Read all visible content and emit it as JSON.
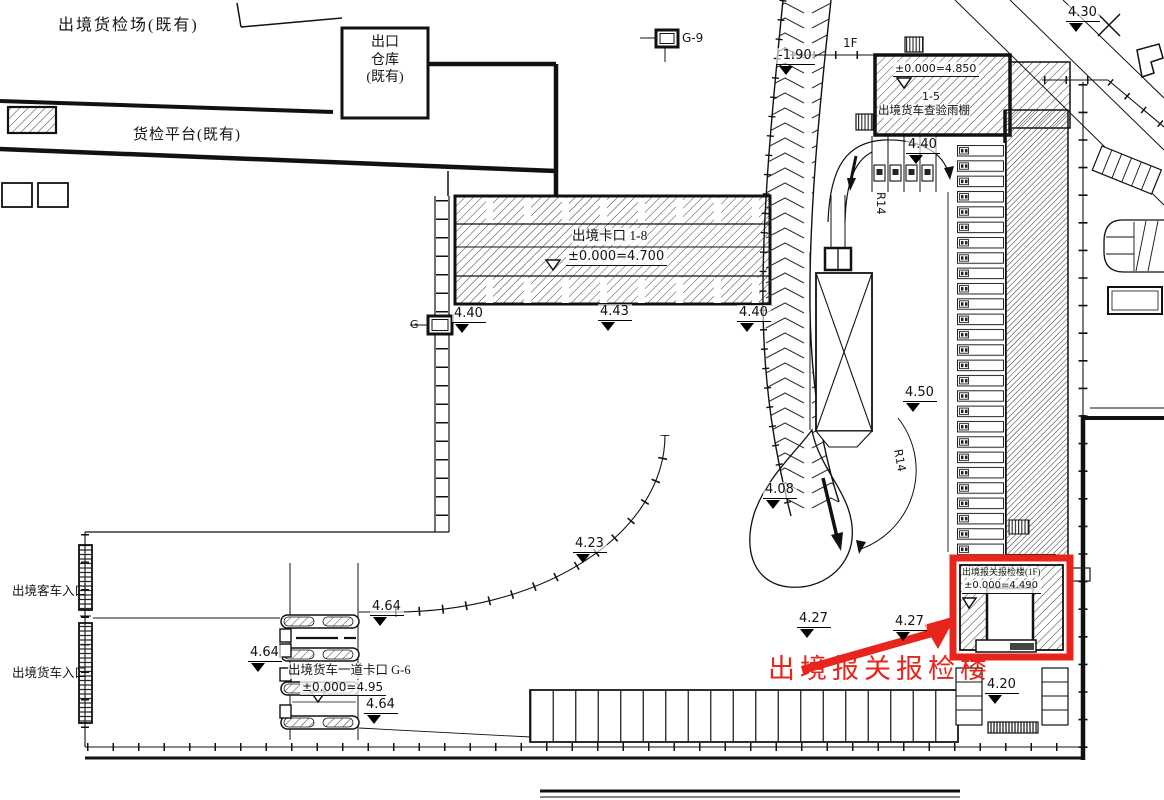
{
  "drawing": {
    "existing_area": {
      "yard_label": "出境货检场(既有)",
      "warehouse_label": "出口\n仓库\n(既有)",
      "platform_label": "货检平台(既有)"
    },
    "checkpoint_main": {
      "label": "出境卡口 1-8",
      "elevation": "±0.000=4.700"
    },
    "canopy": {
      "floor_tag": "1F",
      "elevation": "±0.000=4.850",
      "number": "1-5",
      "label": "出境货车查验雨棚"
    },
    "customs_building": {
      "label": "出境报关报检楼(1F)",
      "elevation": "±0.000=4.490"
    },
    "highlight": {
      "callout": "出境报关报检楼",
      "color": "#e8251c"
    },
    "gate_checkpoint": {
      "label": "出境货车一道卡口 G-6",
      "elevation": "±0.000=4.95"
    },
    "entrances": {
      "passenger": "出境客车入口",
      "truck": "出境货车入口"
    },
    "gates": {
      "g9": "G-9",
      "g_mid": "G-"
    },
    "radius_labels": [
      "R14",
      "R14"
    ],
    "spot_elevations": [
      {
        "value": "4.30",
        "x": 1066,
        "y": 3
      },
      {
        "value": "-1.90",
        "x": 776,
        "y": 46
      },
      {
        "value": "4.40",
        "x": 906,
        "y": 135
      },
      {
        "value": "4.40",
        "x": 452,
        "y": 304
      },
      {
        "value": "4.43",
        "x": 598,
        "y": 302
      },
      {
        "value": "4.40",
        "x": 737,
        "y": 303
      },
      {
        "value": "4.50",
        "x": 903,
        "y": 383
      },
      {
        "value": "4.08",
        "x": 763,
        "y": 480
      },
      {
        "value": "4.23",
        "x": 573,
        "y": 534
      },
      {
        "value": "4.64",
        "x": 370,
        "y": 597
      },
      {
        "value": "4.64",
        "x": 248,
        "y": 643
      },
      {
        "value": "4.64",
        "x": 364,
        "y": 695
      },
      {
        "value": "4.27",
        "x": 797,
        "y": 609
      },
      {
        "value": "4.27",
        "x": 893,
        "y": 612
      },
      {
        "value": "4.20",
        "x": 985,
        "y": 675
      }
    ]
  }
}
